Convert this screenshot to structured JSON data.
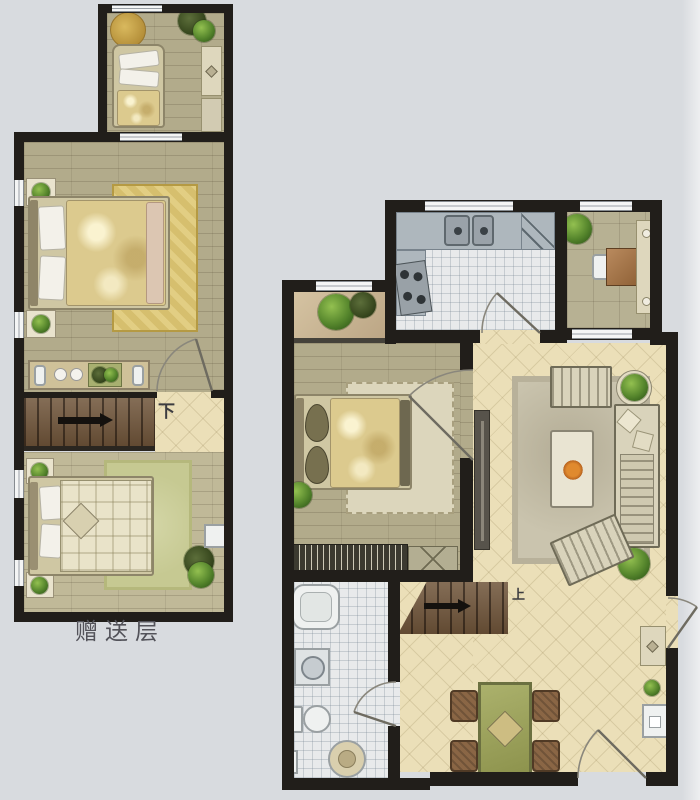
{
  "image_type": "hand-rendered residential floor plan, two levels",
  "palette": {
    "background": "#d8dbdf",
    "wall": "#211e1a",
    "wood_floor": "#b2ab8b",
    "wood_floor_light": "#c0b998",
    "tile_cream": "#ebdfb8",
    "tile_white": "#e8eaeb",
    "stair_brown": "#6f5439",
    "rug_gold": "#d6bf6e",
    "rug_green": "#c6c992",
    "counter_gray": "#aeb7bd",
    "dining_green": "#9aa05e",
    "plant_green": "#55852c",
    "label_text": "#53535a"
  },
  "lower_plan": {
    "label": "赠送层",
    "stairs_label": "下",
    "rooms": [
      {
        "name": "loft-room",
        "furniture": [
          "single-bed",
          "round-rug",
          "plant",
          "wardrobe-cabinets",
          "window"
        ]
      },
      {
        "name": "bedroom-upper",
        "furniture": [
          "double-bed",
          "gold-rug",
          "corner-planters",
          "dresser-with-plant-and-dishes",
          "windows"
        ]
      },
      {
        "name": "stair-hall",
        "furniture": [
          "staircase-down",
          "direction-arrow",
          "tiled-landing",
          "door"
        ]
      },
      {
        "name": "bedroom-lower",
        "furniture": [
          "bed-plaid",
          "green-rug",
          "corner-planters",
          "floor-plant",
          "wall-unit",
          "windows"
        ]
      }
    ]
  },
  "main_plan": {
    "stairs_label": "上",
    "rooms": [
      {
        "name": "kitchen",
        "furniture": [
          "counter",
          "double-sink",
          "corner-counter",
          "stove",
          "door",
          "window"
        ]
      },
      {
        "name": "study-balcony",
        "furniture": [
          "plant",
          "chair",
          "small-table",
          "side-cabinet",
          "window"
        ]
      },
      {
        "name": "bedroom",
        "furniture": [
          "bay-window-plants",
          "double-bed",
          "rug",
          "corner-plant",
          "bookshelf",
          "cabinet",
          "door"
        ]
      },
      {
        "name": "living-room",
        "furniture": [
          "area-rug",
          "loveseat",
          "coffee-table-with-flower",
          "long-sofa",
          "armchair",
          "tv-console",
          "potted-plants",
          "balcony-door"
        ]
      },
      {
        "name": "bathroom",
        "furniture": [
          "bathtub",
          "washing-machine",
          "toilet",
          "round-basin",
          "door"
        ]
      },
      {
        "name": "stair-hall",
        "furniture": [
          "staircase-up",
          "direction-arrow"
        ]
      },
      {
        "name": "dining-entry",
        "furniture": [
          "dining-table",
          "four-chairs",
          "shoe-cabinet",
          "plant",
          "entry-cabinet",
          "entrance-door"
        ]
      }
    ]
  }
}
